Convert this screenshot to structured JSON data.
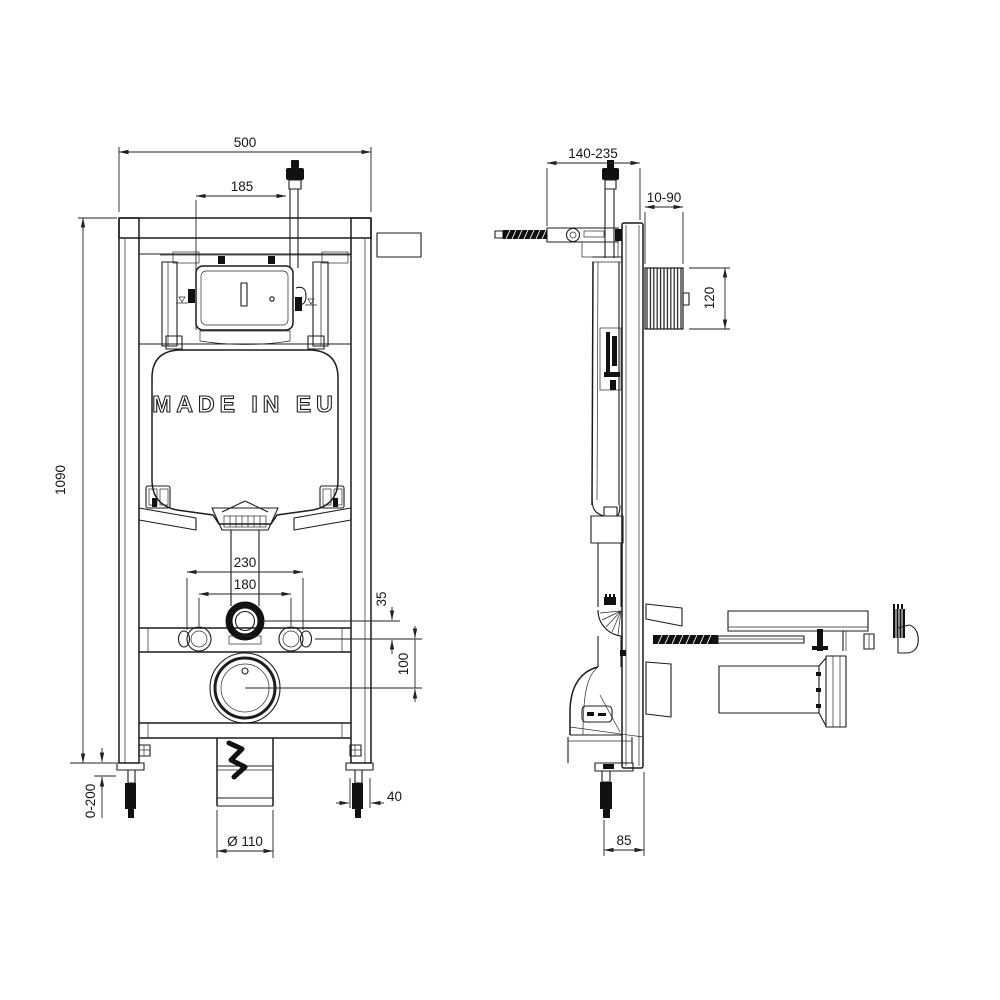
{
  "drawing": {
    "tank_label": "MADE IN EU"
  },
  "dimensions": {
    "front_width": "500",
    "inlet_offset": "185",
    "frame_height": "1090",
    "leg_extension": "0-200",
    "fixing_outer": "230",
    "fixing_inner": "180",
    "drop_small": "35",
    "drop_large": "100",
    "leg_width": "40",
    "drain_diameter": "Ø 110",
    "depth_range": "140-235",
    "plate_depth_range": "10-90",
    "shaft_height": "120",
    "foot_to_wall": "85"
  }
}
